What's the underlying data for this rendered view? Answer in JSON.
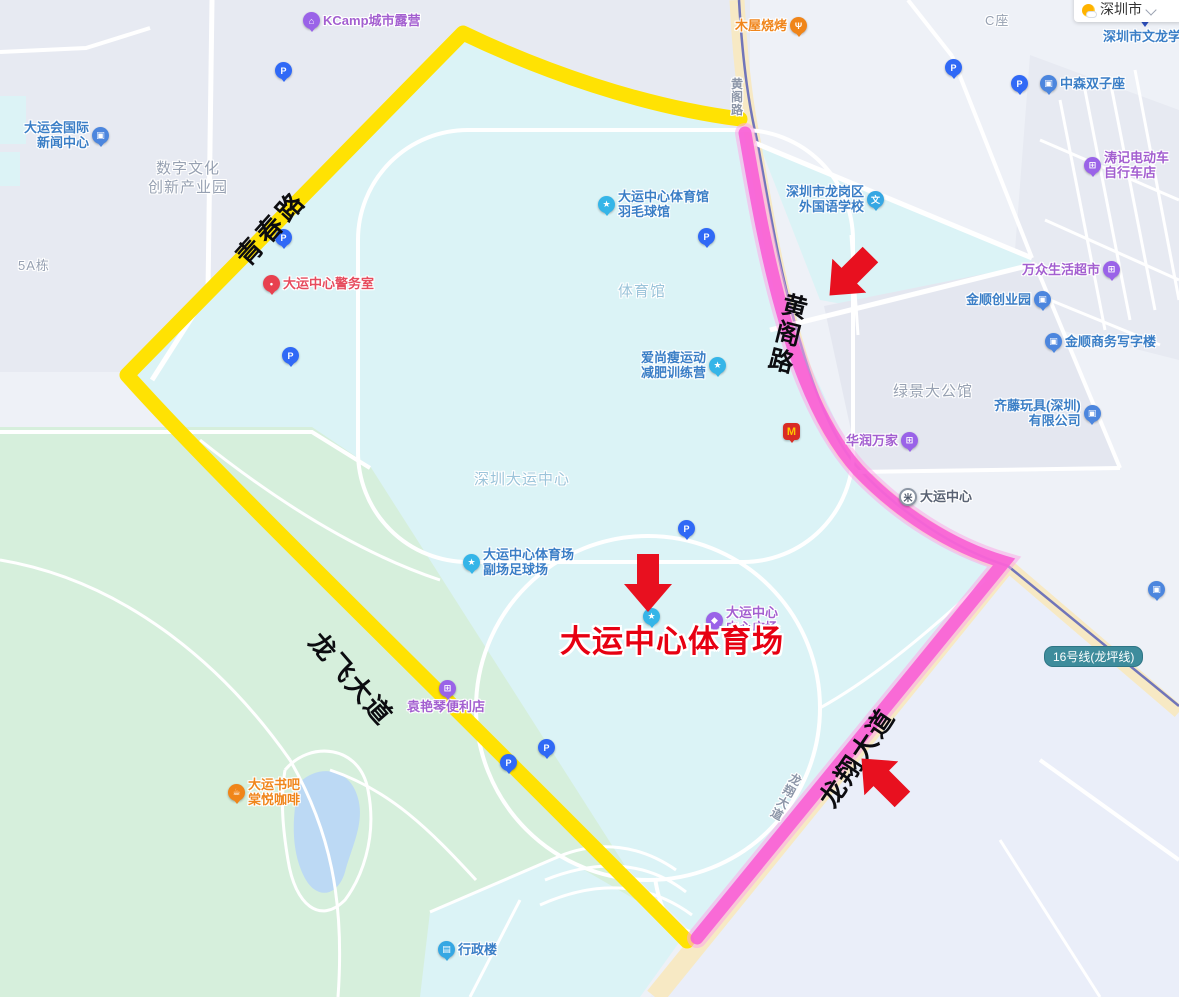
{
  "app": {
    "city_selector": {
      "label": "深圳市"
    }
  },
  "map": {
    "colors": {
      "yellow_route": "#FFE203",
      "pink_route_core": "#F85FD6",
      "pink_route_halo": "#FBA9E8",
      "arrow_red": "#E8101F",
      "destination_red": "#E70012",
      "metro_line": "#6268B8",
      "park_green": "#D6EFDC",
      "campus_cyan": "#DBF3F6",
      "lake_blue": "#BCD9F4"
    },
    "destination_label": "大运中心体育场",
    "metro_badge": {
      "label": "16号线(龙坪线)"
    },
    "highlight_routes": [
      {
        "name": "yellow-route",
        "color": "#FFE203",
        "roads": [
          "青春路",
          "龙飞大道"
        ]
      },
      {
        "name": "pink-route",
        "color": "#F85FD6",
        "roads": [
          "黄阁路",
          "龙翔大道"
        ]
      }
    ],
    "road_labels": [
      {
        "id": "qingchun-lu",
        "text": "青春路",
        "cx": 270,
        "cy": 227,
        "rot": -48,
        "size": 26,
        "ls": 4,
        "color": "#0c0c10",
        "vertical": false,
        "halo": false
      },
      {
        "id": "longfei-dadao",
        "text": "龙飞大道",
        "cx": 352,
        "cy": 678,
        "rot": 49,
        "size": 26,
        "ls": 2,
        "color": "#0c0c10",
        "vertical": false,
        "halo": false
      },
      {
        "id": "huangge-lu-bold",
        "text": "黄阁路",
        "cx": 786,
        "cy": 334,
        "rot": 14,
        "size": 25,
        "ls": 3,
        "color": "#0c0c10",
        "vertical": true,
        "halo": false
      },
      {
        "id": "longxiang-dadao-bold",
        "text": "龙翔大道",
        "cx": 856,
        "cy": 757,
        "rot": -56,
        "size": 26,
        "ls": 2,
        "color": "#0c0c10",
        "vertical": false,
        "halo": false
      },
      {
        "id": "huangge-lu-small",
        "text": "黄阁路",
        "cx": 737,
        "cy": 97,
        "rot": 0,
        "size": 12,
        "ls": 1,
        "color": "#8C96A8",
        "vertical": true,
        "halo": true
      },
      {
        "id": "longxiang-dadao-small",
        "text": "龙翔大道",
        "cx": 786,
        "cy": 797,
        "rot": 28,
        "size": 12,
        "ls": 1,
        "color": "#8C96A8",
        "vertical": true,
        "halo": true
      }
    ],
    "area_labels": [
      {
        "id": "digital-culture-park",
        "x": 113,
        "y": 160,
        "w": 150,
        "center": true,
        "size": 15,
        "color": "#97A1B2",
        "lines": [
          "数字文化",
          "创新产业园"
        ]
      },
      {
        "id": "building-5a",
        "x": 18,
        "y": 258,
        "w": 0,
        "center": false,
        "size": 13,
        "color": "#97A1B2",
        "lines": [
          "5A栋"
        ]
      },
      {
        "id": "block-c",
        "x": 985,
        "y": 13,
        "w": 0,
        "center": false,
        "size": 13,
        "color": "#97A1B2",
        "lines": [
          "C座"
        ]
      },
      {
        "id": "gymnasium",
        "x": 618,
        "y": 283,
        "w": 0,
        "center": false,
        "size": 15,
        "color": "#9BC4DA",
        "lines": [
          "体育馆"
        ]
      },
      {
        "id": "shenzhen-universiade-center",
        "x": 474,
        "y": 471,
        "w": 0,
        "center": false,
        "size": 15,
        "color": "#9BC4DA",
        "lines": [
          "深圳大运中心"
        ]
      },
      {
        "id": "lvjing-mansion",
        "x": 893,
        "y": 383,
        "w": 0,
        "center": false,
        "size": 15,
        "color": "#97A1B2",
        "lines": [
          "绿景大公馆"
        ]
      }
    ],
    "pois": [
      {
        "id": "kcamp-camping",
        "x": 303,
        "y": 12,
        "side": "left",
        "icon": "camp-icon",
        "glyph": "⌂",
        "ic": "#9A63E8",
        "tc": "#A35FD0",
        "lines": [
          "KCamp城市露营"
        ]
      },
      {
        "id": "universiade-news-center",
        "x": 24,
        "y": 120,
        "side": "right",
        "icon": "building-icon",
        "glyph": "▣",
        "ic": "#4C86DE",
        "tc": "#3A7EC6",
        "lines": [
          "大运会国际",
          "新闻中心"
        ]
      },
      {
        "id": "dayun-police-office",
        "x": 263,
        "y": 275,
        "side": "left",
        "icon": "police-icon",
        "glyph": "•",
        "ic": "#E8414F",
        "tc": "#E64C5E",
        "lines": [
          "大运中心警务室"
        ]
      },
      {
        "id": "muwu-bbq",
        "x": 735,
        "y": 17,
        "side": "right",
        "icon": "restaurant-icon",
        "glyph": "Ψ",
        "ic": "#F08519",
        "tc": "#F0861C",
        "lines": [
          "木屋烧烤"
        ]
      },
      {
        "id": "wenlong-school",
        "x": 1103,
        "y": 29,
        "side": "none",
        "icon": "",
        "glyph": "",
        "ic": "",
        "tc": "#3A7EC6",
        "lines": [
          "深圳市文龙学校"
        ]
      },
      {
        "id": "zhongsen-twin-towers",
        "x": 1040,
        "y": 75,
        "side": "left",
        "icon": "building-icon",
        "glyph": "▣",
        "ic": "#4C86DE",
        "tc": "#3A7EC6",
        "lines": [
          "中森双子座"
        ]
      },
      {
        "id": "taoji-ebike-shop",
        "x": 1084,
        "y": 150,
        "side": "left",
        "icon": "shop-icon",
        "glyph": "⊞",
        "ic": "#9A63E8",
        "tc": "#A35FD0",
        "lines": [
          "涛记电动车",
          "自行车店"
        ]
      },
      {
        "id": "longgang-foreign-language-school",
        "x": 786,
        "y": 184,
        "side": "right",
        "icon": "school-icon",
        "glyph": "文",
        "ic": "#35A7E3",
        "tc": "#3A7EC6",
        "lines": [
          "深圳市龙岗区",
          "外国语学校"
        ]
      },
      {
        "id": "wanzhong-supermarket",
        "x": 1022,
        "y": 261,
        "side": "right",
        "icon": "shop-icon",
        "glyph": "⊞",
        "ic": "#9A63E8",
        "tc": "#A35FD0",
        "lines": [
          "万众生活超市"
        ]
      },
      {
        "id": "jinshun-business-park",
        "x": 966,
        "y": 291,
        "side": "right",
        "icon": "building-icon",
        "glyph": "▣",
        "ic": "#4C86DE",
        "tc": "#3A7EC6",
        "lines": [
          "金顺创业园"
        ]
      },
      {
        "id": "jinshun-office-tower",
        "x": 1045,
        "y": 333,
        "side": "left",
        "icon": "building-icon",
        "glyph": "▣",
        "ic": "#4C86DE",
        "tc": "#3A7EC6",
        "lines": [
          "金顺商务写字楼"
        ]
      },
      {
        "id": "qiteng-toys",
        "x": 994,
        "y": 398,
        "side": "right",
        "icon": "building-icon",
        "glyph": "▣",
        "ic": "#4C86DE",
        "tc": "#3A7EC6",
        "lines": [
          "齐藤玩具(深圳)",
          "有限公司"
        ]
      },
      {
        "id": "huarun-vanguard",
        "x": 846,
        "y": 432,
        "side": "right",
        "icon": "shop-icon",
        "glyph": "⊞",
        "ic": "#9A63E8",
        "tc": "#A35FD0",
        "lines": [
          "华润万家"
        ]
      },
      {
        "id": "metro-dayun-station",
        "x": 899,
        "y": 488,
        "side": "left",
        "icon": "metro-icon",
        "glyph": "米",
        "ic": "metro",
        "tc": "#596273",
        "lines": [
          "大运中心"
        ]
      },
      {
        "id": "badminton-hall",
        "x": 598,
        "y": 189,
        "side": "left",
        "icon": "sports-icon",
        "glyph": "★",
        "ic": "#35B5E8",
        "tc": "#3A7EC6",
        "lines": [
          "大运中心体育馆",
          "羽毛球馆"
        ]
      },
      {
        "id": "aishangshou-camp",
        "x": 641,
        "y": 350,
        "side": "right",
        "icon": "sports-icon",
        "glyph": "★",
        "ic": "#35B5E8",
        "tc": "#3A7EC6",
        "lines": [
          "爱尚瘦运动",
          "减肥训练营"
        ]
      },
      {
        "id": "mcdonalds",
        "x": 783,
        "y": 423,
        "side": "left",
        "icon": "mcdonalds-icon",
        "glyph": "M",
        "ic": "mcd",
        "tc": "#333333",
        "lines": []
      },
      {
        "id": "stadium-subfield",
        "x": 463,
        "y": 547,
        "side": "left",
        "icon": "sports-icon",
        "glyph": "★",
        "ic": "#35B5E8",
        "tc": "#3A7EC6",
        "lines": [
          "大运中心体育场",
          "副场足球场"
        ]
      },
      {
        "id": "stadium-marker",
        "x": 643,
        "y": 608,
        "side": "left",
        "icon": "sports-icon",
        "glyph": "★",
        "ic": "#35B5E8",
        "tc": "#3A7EC6",
        "lines": []
      },
      {
        "id": "dayun-central-plaza",
        "x": 706,
        "y": 605,
        "side": "left",
        "icon": "plaza-icon",
        "glyph": "◆",
        "ic": "#9A63E8",
        "tc": "#A35FD0",
        "lines": [
          "大运中心",
          "中心广场"
        ]
      },
      {
        "id": "yuanyanqin-store",
        "x": 407,
        "y": 680,
        "side": "above",
        "icon": "shop-icon",
        "glyph": "⊞",
        "ic": "#9A63E8",
        "tc": "#A35FD0",
        "lines": [
          "袁艳琴便利店"
        ]
      },
      {
        "id": "dayun-bookbar-cafe",
        "x": 228,
        "y": 777,
        "side": "left",
        "icon": "coffee-icon",
        "glyph": "☕",
        "ic": "#F08519",
        "tc": "#F0861C",
        "lines": [
          "大运书吧",
          "棠悦咖啡"
        ]
      },
      {
        "id": "admin-building",
        "x": 438,
        "y": 941,
        "side": "left",
        "icon": "building-icon",
        "glyph": "▤",
        "ic": "#35A7E3",
        "tc": "#3A7EC6",
        "lines": [
          "行政楼"
        ]
      },
      {
        "id": "east-edge-poi",
        "x": 1148,
        "y": 581,
        "side": "left",
        "icon": "building-icon",
        "glyph": "▣",
        "ic": "#4C86DE",
        "tc": "#3A7EC6",
        "lines": []
      }
    ],
    "parkings": [
      {
        "x": 283,
        "y": 70
      },
      {
        "x": 283,
        "y": 237
      },
      {
        "x": 290,
        "y": 355
      },
      {
        "x": 706,
        "y": 236
      },
      {
        "x": 686,
        "y": 528
      },
      {
        "x": 953,
        "y": 67
      },
      {
        "x": 1019,
        "y": 83
      },
      {
        "x": 508,
        "y": 762
      },
      {
        "x": 546,
        "y": 747
      }
    ],
    "arrows": [
      {
        "id": "arrow-stadium",
        "x": 624,
        "y": 554,
        "rot": 0
      },
      {
        "id": "arrow-huangge-road",
        "x": 826,
        "y": 246,
        "rot": 45
      },
      {
        "id": "arrow-longxiang-road",
        "x": 858,
        "y": 750,
        "rot": 135
      }
    ]
  }
}
